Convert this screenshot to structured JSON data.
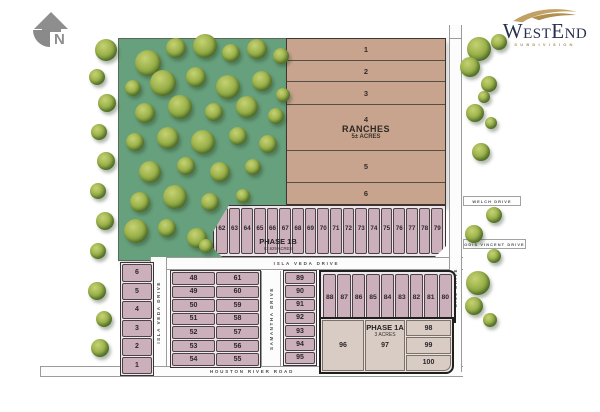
{
  "north": {
    "label": "N"
  },
  "logo": {
    "name": "WestEnd",
    "subtitle": "SUBDIVISION"
  },
  "colors": {
    "woods_green": "#67a07c",
    "lot_pink": "#cbafba",
    "ranch_tan": "#c8a48e",
    "phase1a_fill": "#d8ccc5",
    "road_white": "#fcfcfc",
    "logo_navy": "#27304f",
    "logo_gold": "#c2a264"
  },
  "ranches": {
    "title": "RANCHES",
    "acres": "5± ACRES",
    "lots": [
      "1",
      "2",
      "3",
      "4",
      "5",
      "6"
    ]
  },
  "phase_1b": {
    "title": "PHASE 1B",
    "acres": "62.629 ACRES",
    "lots": [
      "62",
      "63",
      "64",
      "65",
      "66",
      "67",
      "68",
      "69",
      "70",
      "71",
      "72",
      "73",
      "74",
      "75",
      "76",
      "77",
      "78",
      "79"
    ]
  },
  "phase_1a": {
    "title": "PHASE 1A",
    "acres": "3 ACRES",
    "lot_96": "96",
    "lot_97": "97",
    "stack_lots": [
      "98",
      "99",
      "100"
    ]
  },
  "west_lots": [
    "6",
    "5",
    "4",
    "3",
    "2",
    "1"
  ],
  "center_block": {
    "left": [
      "48",
      "49",
      "50",
      "51",
      "52",
      "53",
      "54"
    ],
    "right": [
      "61",
      "60",
      "59",
      "58",
      "57",
      "56",
      "55"
    ]
  },
  "east_column": [
    "89",
    "90",
    "91",
    "92",
    "93",
    "94",
    "95"
  ],
  "north_row": [
    "88",
    "87",
    "86",
    "85",
    "84",
    "83",
    "82",
    "81",
    "80"
  ],
  "streets": {
    "isla_veda_h": "ISLA VEDA DRIVE",
    "isla_veda_v": "ISLA VEDA DRIVE",
    "samantha": "SAMANTHA DRIVE",
    "houston": "HOUSTON RIVER ROAD",
    "welch": "WELCH DRIVE",
    "odis": "ODIS VINCENT DRIVE",
    "gill": "GILL DRIVE"
  },
  "trees": [
    [
      148,
      63,
      13
    ],
    [
      176,
      48,
      10
    ],
    [
      205,
      46,
      12
    ],
    [
      231,
      53,
      9
    ],
    [
      257,
      49,
      10
    ],
    [
      281,
      56,
      8
    ],
    [
      133,
      88,
      8
    ],
    [
      163,
      83,
      13
    ],
    [
      196,
      77,
      10
    ],
    [
      228,
      87,
      12
    ],
    [
      262,
      81,
      10
    ],
    [
      283,
      95,
      7
    ],
    [
      145,
      113,
      10
    ],
    [
      180,
      107,
      12
    ],
    [
      214,
      112,
      9
    ],
    [
      247,
      107,
      11
    ],
    [
      276,
      116,
      8
    ],
    [
      135,
      142,
      9
    ],
    [
      168,
      138,
      11
    ],
    [
      203,
      142,
      12
    ],
    [
      238,
      136,
      9
    ],
    [
      268,
      144,
      9
    ],
    [
      150,
      172,
      11
    ],
    [
      186,
      166,
      9
    ],
    [
      220,
      172,
      10
    ],
    [
      253,
      167,
      8
    ],
    [
      140,
      202,
      10
    ],
    [
      175,
      197,
      12
    ],
    [
      210,
      202,
      9
    ],
    [
      243,
      196,
      7
    ],
    [
      136,
      231,
      12
    ],
    [
      167,
      228,
      9
    ],
    [
      197,
      238,
      10
    ],
    [
      206,
      246,
      7
    ],
    [
      106,
      50,
      11
    ],
    [
      97,
      77,
      8
    ],
    [
      107,
      103,
      9
    ],
    [
      99,
      132,
      8
    ],
    [
      106,
      161,
      9
    ],
    [
      98,
      191,
      8
    ],
    [
      105,
      221,
      9
    ],
    [
      98,
      251,
      8
    ],
    [
      97,
      291,
      9
    ],
    [
      104,
      319,
      8
    ],
    [
      100,
      348,
      9
    ],
    [
      479,
      49,
      12
    ],
    [
      499,
      42,
      8
    ],
    [
      470,
      67,
      10
    ],
    [
      489,
      84,
      8
    ],
    [
      484,
      97,
      6
    ],
    [
      475,
      113,
      9
    ],
    [
      491,
      123,
      6
    ],
    [
      481,
      152,
      9
    ],
    [
      494,
      215,
      8
    ],
    [
      474,
      234,
      9
    ],
    [
      494,
      256,
      7
    ],
    [
      478,
      283,
      12
    ],
    [
      474,
      306,
      9
    ],
    [
      490,
      320,
      7
    ]
  ]
}
